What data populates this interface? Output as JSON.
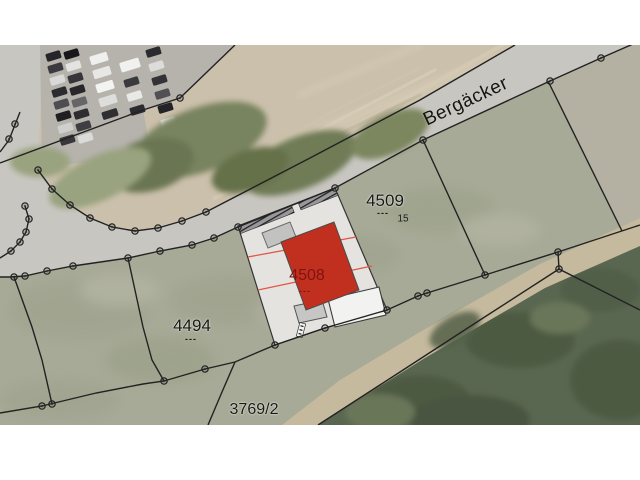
{
  "map": {
    "street_name": "Bergäcker",
    "parcels": {
      "p4509": {
        "id": "4509",
        "marks": "---",
        "house_no": "15"
      },
      "p4494": {
        "id": "4494",
        "marks": "---"
      },
      "p3769_2": {
        "id": "3769/2"
      },
      "p4508": {
        "id": "4508",
        "marks": "---"
      }
    },
    "colors": {
      "highlight_fill": "#c1301f",
      "highlight_label": "#7e1410",
      "setback_line": "#e2564a",
      "boundary": "#222222",
      "road_surface": "#c8c6c0",
      "plot_fill": "#e4e3e0",
      "field_north": "#cbc0ac",
      "field_south": "#a7aa96",
      "forest": "#5a6750"
    }
  }
}
